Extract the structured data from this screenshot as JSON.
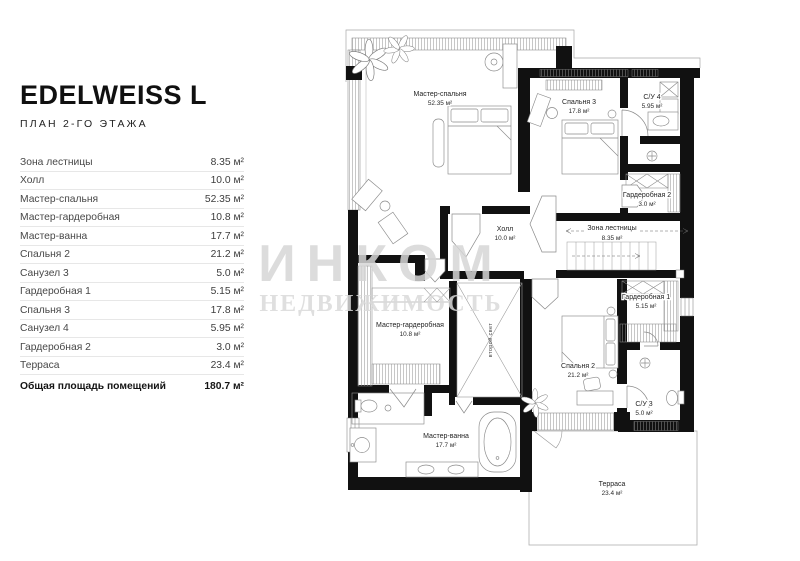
{
  "header": {
    "title": "EDELWEISS L",
    "subtitle": "ПЛАН 2-ГО ЭТАЖА"
  },
  "table": {
    "rows": [
      {
        "label": "Зона лестницы",
        "value": "8.35 м²"
      },
      {
        "label": "Холл",
        "value": "10.0 м²"
      },
      {
        "label": "Мастер-спальня",
        "value": "52.35 м²"
      },
      {
        "label": "Мастер-гардеробная",
        "value": "10.8 м²"
      },
      {
        "label": "Мастер-ванна",
        "value": "17.7 м²"
      },
      {
        "label": "Спальня 2",
        "value": "21.2 м²"
      },
      {
        "label": "Санузел 3",
        "value": "5.0 м²"
      },
      {
        "label": "Гардеробная 1",
        "value": "5.15 м²"
      },
      {
        "label": "Спальня 3",
        "value": "17.8 м²"
      },
      {
        "label": "Санузел 4",
        "value": "5.95 м²"
      },
      {
        "label": "Гардеробная 2",
        "value": "3.0 м²"
      },
      {
        "label": "Терраса",
        "value": "23.4 м²"
      }
    ],
    "total": {
      "label": "Общая площадь помещений",
      "value": "180.7 м²"
    }
  },
  "plan": {
    "rooms": [
      {
        "name": "Мастер-спальня",
        "area": "52.35 м²"
      },
      {
        "name": "Спальня 3",
        "area": "17.8 м²"
      },
      {
        "name": "С/У 4",
        "area": "5.95 м²"
      },
      {
        "name": "Гардеробная 2",
        "area": "3.0 м²"
      },
      {
        "name": "Зона лестницы",
        "area": "8.35 м²"
      },
      {
        "name": "Холл",
        "area": "10.0 м²"
      },
      {
        "name": "Гардеробная 1",
        "area": "5.15 м²"
      },
      {
        "name": "Мастер-гардеробная",
        "area": "10.8 м²"
      },
      {
        "name": "Спальня 2",
        "area": "21.2 м²"
      },
      {
        "name": "С/У 3",
        "area": "5.0 м²"
      },
      {
        "name": "Мастер-ванна",
        "area": "17.7 м²"
      },
      {
        "name": "Терраса",
        "area": "23.4 м²"
      },
      {
        "name": "второй свет",
        "area": ""
      }
    ],
    "watermark": {
      "line1": "ИНКОМ",
      "line2": "НЕДВИЖИМОСТЬ"
    }
  },
  "colors": {
    "wall": "#111111",
    "line": "#8a8a8a",
    "text": "#1f1f1f",
    "watermark": "#d6d6d6"
  }
}
